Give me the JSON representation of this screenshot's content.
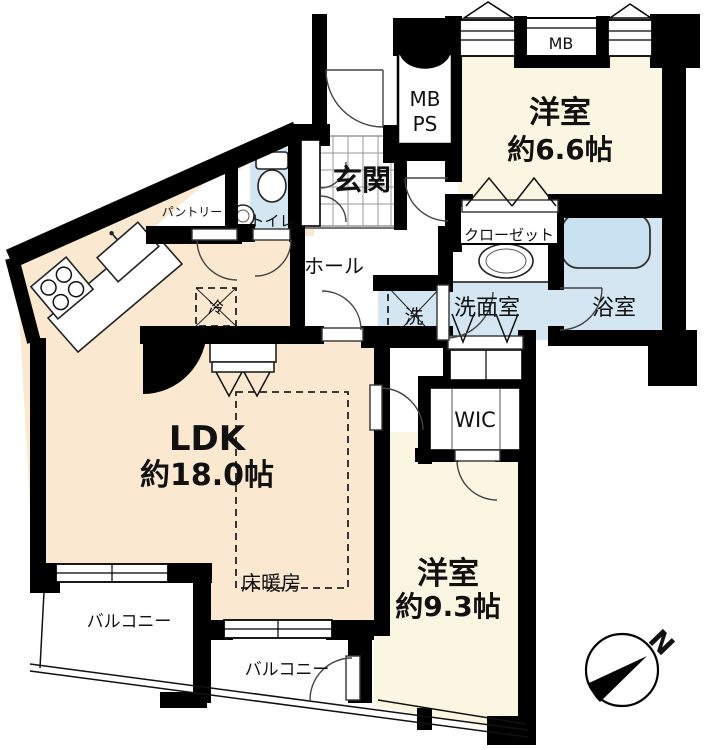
{
  "floorplan": {
    "rooms": {
      "ldk": {
        "name": "LDK",
        "area": "約18.0帖"
      },
      "bedroom_66": {
        "name": "洋室",
        "area": "約6.6帖"
      },
      "bedroom_93": {
        "name": "洋室",
        "area": "約9.3帖"
      },
      "entrance": "玄関",
      "hall": "ホール",
      "toilet": "トイレ",
      "pantry": "パントリー",
      "closet": "クローゼット",
      "walk_in_closet": "WIC",
      "washroom": "洗面室",
      "bathroom": "浴室",
      "balcony_left": "バルコニー",
      "balcony_center": "バルコニー",
      "floor_heating": "床暖房"
    },
    "equipment": {
      "meter_box": "MB",
      "shaft_line1": "MB",
      "shaft_line2": "PS",
      "washer": "洗",
      "refrigerator": "冷"
    },
    "compass": {
      "north_label": "N"
    },
    "colors": {
      "ldk_floor": "#FBE8D0",
      "bedroom_floor": "#FAF6E1",
      "wet_area_floor": "#D3E6F2",
      "bathtub": "#C9E1F0",
      "wall": "#000000",
      "background": "#FFFFFF"
    }
  }
}
